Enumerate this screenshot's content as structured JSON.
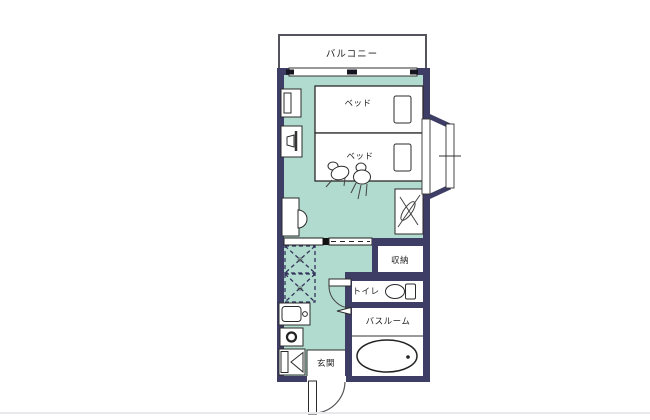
{
  "floorplan": {
    "labels": {
      "balcony": "バルコニー",
      "bed_upper": "ベッド",
      "bed_lower": "ベッド",
      "storage": "収納",
      "toilet": "トイレ",
      "bathroom": "バスルーム",
      "entrance": "玄関"
    },
    "marks": {
      "overhead_storage": "※"
    },
    "colors": {
      "wall": "#3d3d66",
      "floor": "#b1dbce",
      "outline": "#2b2b2b",
      "balcony_border": "#54545c",
      "separator": "#e9e9ed",
      "text": "#222222"
    },
    "icons": [
      "bed",
      "pillow",
      "wall-cabinet",
      "tv",
      "desk",
      "desk-chair",
      "low-chair",
      "luggage-rack",
      "bay-window",
      "sliding-door",
      "overhead-storage",
      "kitchen-sink",
      "stove-burner",
      "shoe-cabinet",
      "toilet",
      "toilet-door",
      "bathroom-door",
      "bathtub",
      "bathtub-drain",
      "entrance-door",
      "window"
    ]
  }
}
